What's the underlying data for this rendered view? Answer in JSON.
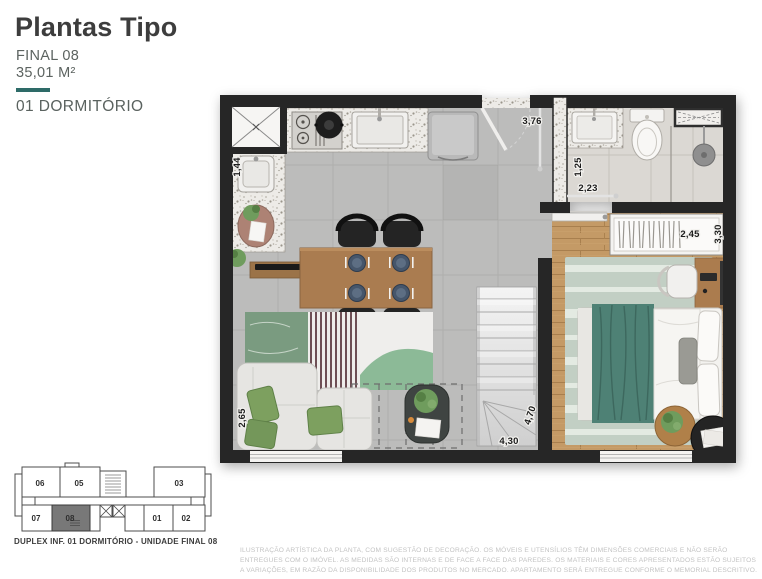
{
  "header": {
    "title": "Plantas Tipo",
    "unit_final": "FINAL 08",
    "area": "35,01 M²",
    "typology": "01 DORMITÓRIO"
  },
  "plan": {
    "dimensions": {
      "kitchen_side": "1,44",
      "hall_depth": "3,76",
      "bathroom_width": "1,25",
      "bathroom_length": "2,23",
      "bedroom_width": "2,45",
      "bedroom_depth": "3,30",
      "living_width": "2,65",
      "living_depth": "4,70",
      "living_length": "4,30"
    },
    "colors": {
      "wall": "#262626",
      "floor_tile": "#bcbcbb",
      "floor_wood": "#c49a66",
      "floor_bath": "#dbd8d3",
      "accent_green": "#7da05f",
      "accent_teal_bedding": "#4e8175",
      "brand_teal": "#2e6b68"
    }
  },
  "keyplan": {
    "units": [
      "06",
      "05",
      "03",
      "07",
      "08",
      "01",
      "02"
    ],
    "highlighted_unit": "08",
    "caption": "DUPLEX INF. 01 DORMITÓRIO - UNIDADE FINAL 08"
  },
  "disclaimer": {
    "text": "ILUSTRAÇÃO ARTÍSTICA DA PLANTA, COM SUGESTÃO DE DECORAÇÃO. OS MÓVEIS E UTENSÍLIOS TÊM DIMENSÕES COMERCIAIS E NÃO SERÃO ENTREGUES COM O IMÓVEL. AS MEDIDAS SÃO INTERNAS E DE FACE A FACE DAS PAREDES. OS MATERIAIS E CORES APRESENTADOS ESTÃO SUJEITOS A VARIAÇÕES, EM RAZÃO DA DISPONIBILIDADE DOS PRODUTOS NO MERCADO. APARTAMENTO SERÁ ENTREGUE CONFORME O MEMORIAL DESCRITIVO."
  }
}
